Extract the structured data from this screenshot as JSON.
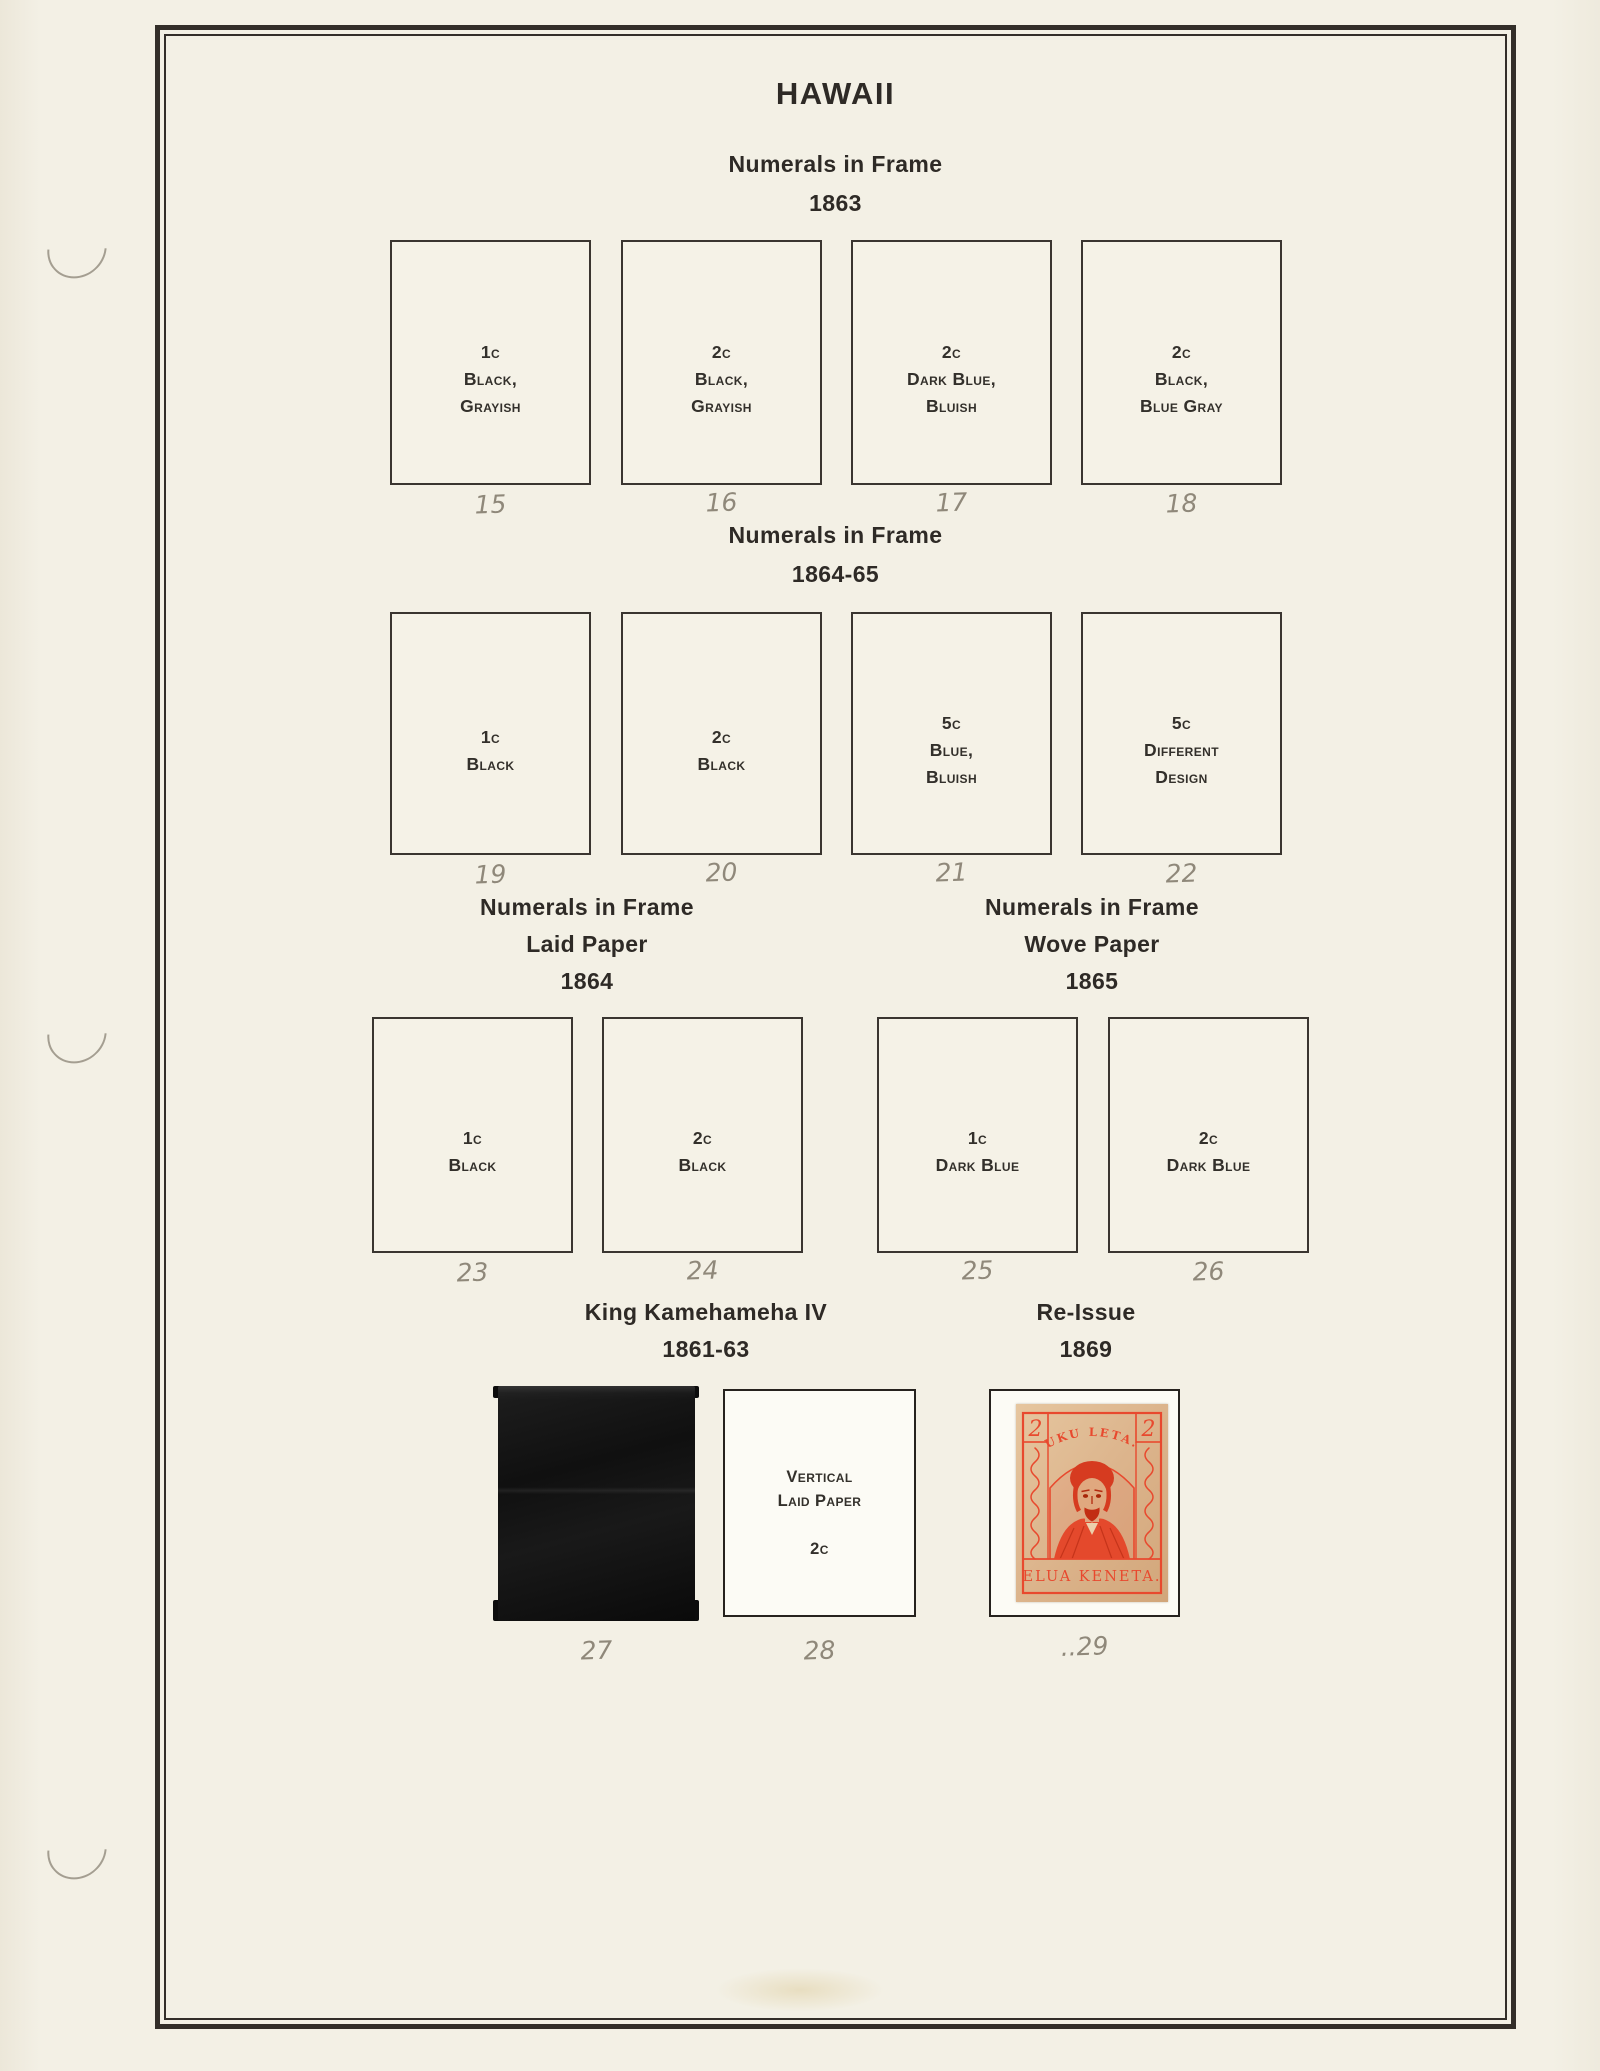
{
  "page": {
    "title": "HAWAII"
  },
  "colors": {
    "stamp_red": "#e8492e",
    "stamp_paper": "#dcb48c",
    "pencil_gray": "#8f887a",
    "mount_black": "#101010"
  },
  "sections": [
    {
      "heading": "Numerals in Frame",
      "year": "1863",
      "boxes": [
        {
          "lines": [
            "1c",
            "Black,",
            "Grayish"
          ],
          "number": "15"
        },
        {
          "lines": [
            "2c",
            "Black,",
            "Grayish"
          ],
          "number": "16"
        },
        {
          "lines": [
            "2c",
            "Dark Blue,",
            "Bluish"
          ],
          "number": "17"
        },
        {
          "lines": [
            "2c",
            "Black,",
            "Blue Gray"
          ],
          "number": "18"
        }
      ]
    },
    {
      "heading": "Numerals in Frame",
      "year": "1864-65",
      "boxes": [
        {
          "lines": [
            "1c",
            "Black"
          ],
          "number": "19"
        },
        {
          "lines": [
            "2c",
            "Black"
          ],
          "number": "20"
        },
        {
          "lines": [
            "5c",
            "Blue,",
            "Bluish"
          ],
          "number": "21"
        },
        {
          "lines": [
            "5c",
            "Different",
            "Design"
          ],
          "number": "22"
        }
      ]
    },
    {
      "left_heading": {
        "lines": [
          "Numerals in Frame",
          "Laid Paper",
          "1864"
        ]
      },
      "right_heading": {
        "lines": [
          "Numerals in Frame",
          "Wove Paper",
          "1865"
        ]
      },
      "boxes": [
        {
          "lines": [
            "1c",
            "Black"
          ],
          "number": "23"
        },
        {
          "lines": [
            "2c",
            "Black"
          ],
          "number": "24"
        },
        {
          "lines": [
            "1c",
            "Dark Blue"
          ],
          "number": "25"
        },
        {
          "lines": [
            "2c",
            "Dark Blue"
          ],
          "number": "26"
        }
      ]
    },
    {
      "left_heading": {
        "lines": [
          "King Kamehameha IV",
          "1861-63"
        ]
      },
      "right_heading": {
        "lines": [
          "Re-Issue",
          "1869"
        ]
      },
      "mount": {
        "number": "27"
      },
      "box28": {
        "lines": [
          "Vertical",
          "Laid Paper"
        ],
        "value": "2c",
        "number": "28"
      },
      "stamp29": {
        "number": "..29",
        "corner_value": "2",
        "top_text": "UKU LETA.",
        "bottom_text": "ELUA KENETA."
      }
    }
  ]
}
